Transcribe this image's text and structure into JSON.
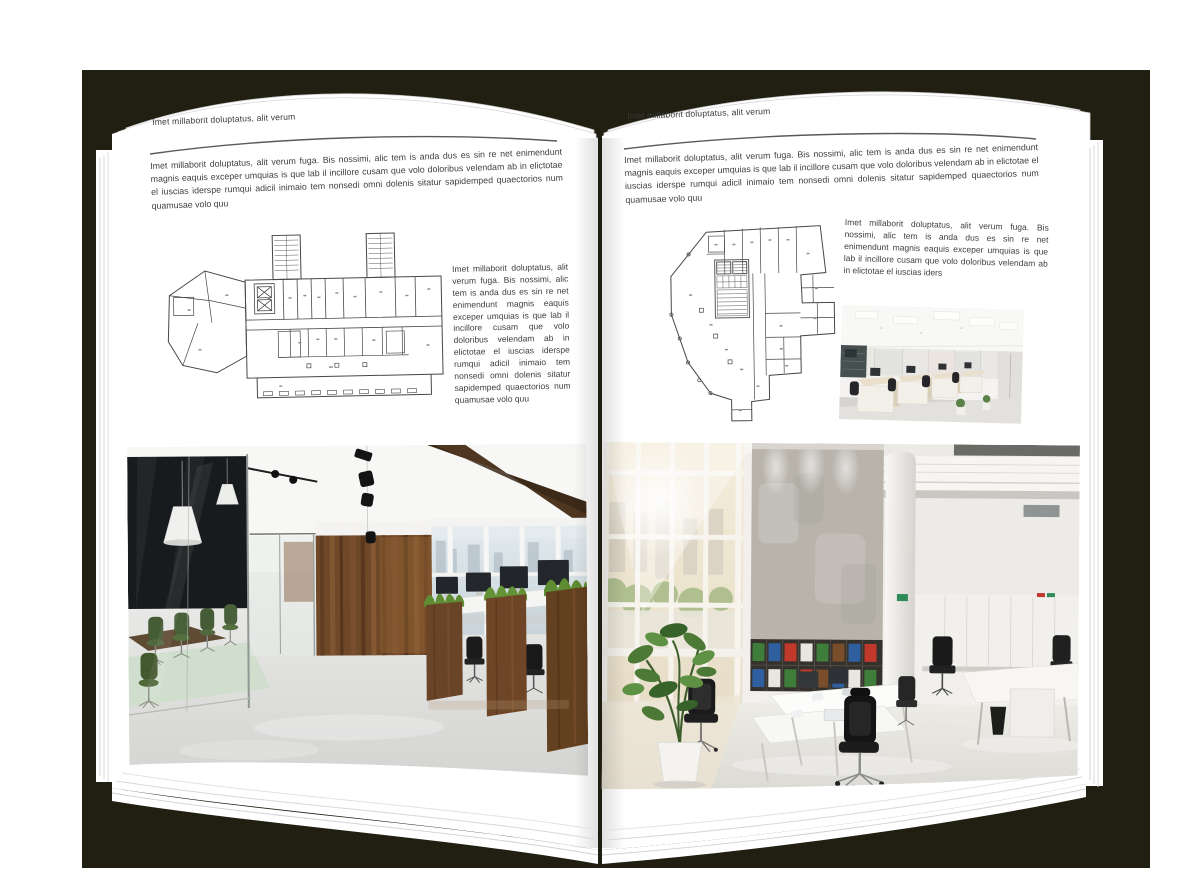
{
  "palette": {
    "backdrop": "#201f11",
    "page": "#ffffff",
    "text": "#3c3c3c",
    "rule": "#58585a",
    "wood": "#6f4828",
    "plant_green": "#4e7a36",
    "concrete": "#b8b4ac"
  },
  "left_page": {
    "running_head": "Imet millaborit doluptatus, alit verum",
    "intro": "Imet millaborit doluptatus, alit verum fuga. Bis nossimi, alic tem is anda dus es sin re net enimendunt magnis eaquis exceper umquias is que lab il incillore cusam que volo doloribus velendam ab in elictotae el iuscias iderspe rumqui adicil inimaio tem nonsedi omni dolenis sitatur sapidemped quaectorios num quamusae volo quu",
    "side_text": "Imet millaborit doluptatus, alit verum fuga. Bis nossimi, alic tem is anda dus es sin re net enimendunt magnis eaquis exceper umquias is que lab il incillore cusam que volo doloribus velendam ab in elictotae el iuscias iderspe rumqui adicil inimaio tem nonsedi omni dolenis sitatur sapidemped quaectorios num quamusae volo quu"
  },
  "right_page": {
    "running_head": "Imet millaborit doluptatus, alit verum",
    "intro": "Imet millaborit doluptatus, alit verum fuga. Bis nossimi, alic tem is anda dus es sin re net enimendunt magnis eaquis exceper umquias is que lab il incillore cusam que volo doloribus velendam ab in elictotae el iuscias iderspe rumqui adicil inimaio tem nonsedi omni dolenis sitatur sapidemped quaectorios num quamusae volo quu",
    "side_text": "Imet millaborit doluptatus, alit verum fuga. Bis nossimi, alic tem is anda dus es sin re net enimendunt magnis eaquis exceper umquias is que lab il incillore cusam que volo doloribus velendam ab in elictotae el iuscias iders"
  }
}
